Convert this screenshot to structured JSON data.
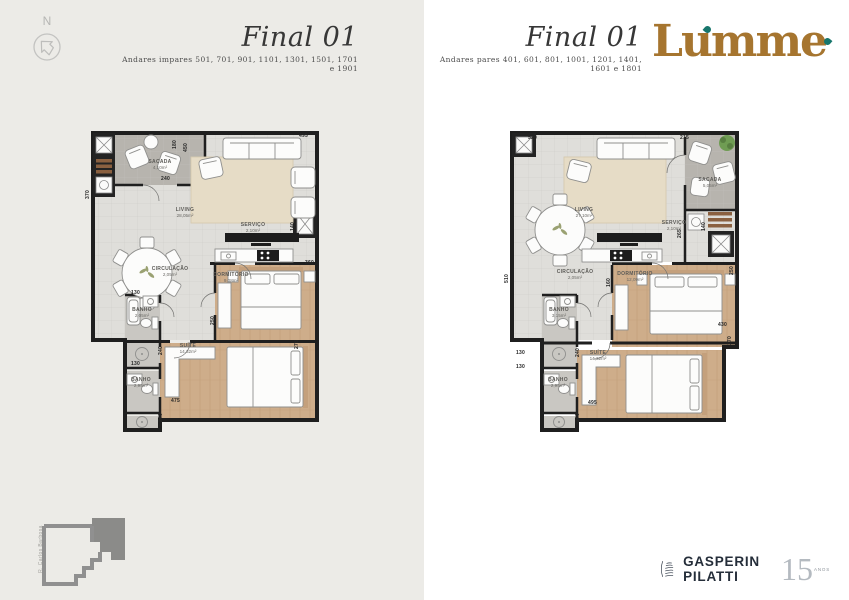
{
  "header": {
    "compass_label": "N",
    "left": {
      "title": "Final 01",
      "subtitle": "Andares impares 501, 701, 901, 1101, 1301, 1501, 1701 e 1901"
    },
    "right": {
      "title": "Final 01",
      "subtitle": "Andares pares 401, 601, 801, 1001, 1201, 1401, 1601 e 1801"
    },
    "brand": {
      "name": "Lumme",
      "color": "#a6752f",
      "accent": "#17766c"
    }
  },
  "plan_left": {
    "rooms": {
      "sacada": {
        "name": "SACADA",
        "area": "4,10m²"
      },
      "living": {
        "name": "LIVING",
        "area": "28,05m²"
      },
      "servico": {
        "name": "SERVIÇO",
        "area": "2,10m²"
      },
      "circulacao": {
        "name": "CIRCULAÇÃO",
        "area": "2,05m²"
      },
      "dormitorio": {
        "name": "DORMITÓRIO",
        "area": "9,08m²"
      },
      "banho1": {
        "name": "BANHO",
        "area": "2,05m²"
      },
      "suite": {
        "name": "SUÍTE",
        "area": "14,32m²"
      },
      "banho2": {
        "name": "BANHO",
        "area": "2,95m²"
      }
    },
    "dims": [
      "180",
      "450",
      "495",
      "240",
      "370",
      "140",
      "360",
      "250",
      "275",
      "130",
      "240",
      "130",
      "475",
      "240"
    ]
  },
  "plan_right": {
    "rooms": {
      "sacada": {
        "name": "SACADA",
        "area": "5,05m²"
      },
      "living": {
        "name": "LIVING",
        "area": "27,10m²"
      },
      "servico": {
        "name": "SERVIÇO",
        "area": "2,10m²"
      },
      "circulacao": {
        "name": "CIRCULAÇÃO",
        "area": "2,05m²"
      },
      "dormitorio": {
        "name": "DORMITÓRIO",
        "area": "12,09m²"
      },
      "banho1": {
        "name": "BANHO",
        "area": "3,15m²"
      },
      "suite": {
        "name": "SUÍTE",
        "area": "14,32m²"
      },
      "banho2": {
        "name": "BANHO",
        "area": "2,95m²"
      }
    },
    "dims": [
      "520",
      "215",
      "265",
      "140",
      "160",
      "250",
      "430",
      "270",
      "510",
      "130",
      "240",
      "130",
      "495",
      "240"
    ]
  },
  "keyplan": {
    "street": "R. Carlos Barbosa"
  },
  "footer": {
    "developer": "GASPERIN PILATTI",
    "anniversary_number": "15",
    "anniversary_label": "ANOS"
  }
}
